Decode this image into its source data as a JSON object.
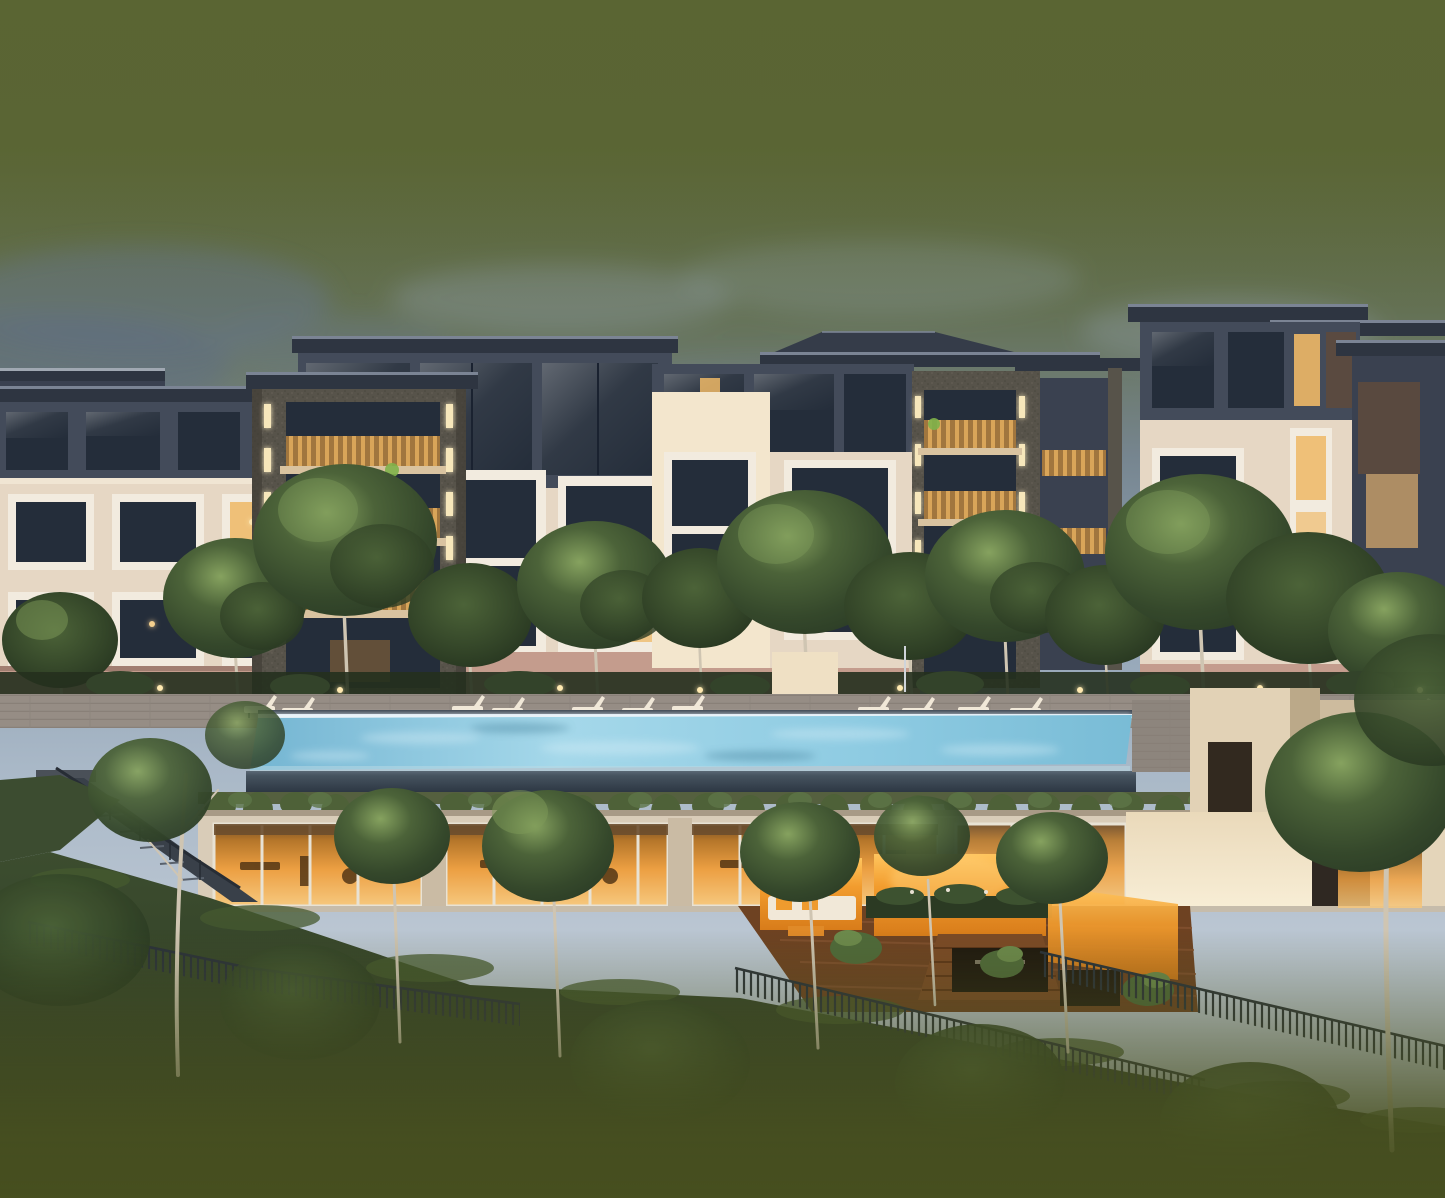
{
  "scene": {
    "type": "architectural-rendering",
    "time_of_day": "dusk",
    "subject": "low-rise condominium complex with infinity lap pool, lounge deck, glass gym pavilion, orange courtyard terraces and landscaped hillside",
    "text_visible": "none"
  },
  "palette": {
    "sky_olive": "#5a6433",
    "sky_mid": "#8ea0b2",
    "sky_light": "#bdc8d4",
    "cloud_dark": "#66758c",
    "cloud_light": "#97a7ba",
    "roof_dark": "#2e3541",
    "roof_edge": "#7b8494",
    "facade_dark": "#434b5a",
    "facade_dark2": "#3a4150",
    "facade_cream": "#e6d7c4",
    "facade_cream_lit": "#f3e6cd",
    "facade_pink": "#c49c8d",
    "window_dark": "#242d3a",
    "window_frame": "#f2ebdf",
    "window_lit": "#eeb866",
    "balcony_gold": "#cf9f57",
    "stone_pier": "#57534a",
    "strip_light": "#f7e7bb",
    "tree_dark": "#2c3d26",
    "tree_mid": "#4c6339",
    "tree_lit": "#7d9a58",
    "deck_grey": "#968d85",
    "pool_water": "#8ecbe2",
    "pool_led": "#eef8ff",
    "overflow_dark": "#2a3440",
    "vine_green": "#4e6138",
    "interior_orange": "#ec9f42",
    "courtyard_orange": "#f29c2e",
    "wood_brown": "#7a4a28",
    "sofa_white": "#f1e8d8",
    "hill_green": "#2f3b27",
    "fence_dark": "#2a313a",
    "trunk_pale": "#cfc5b2",
    "bottom_olive": "#474f1f"
  }
}
